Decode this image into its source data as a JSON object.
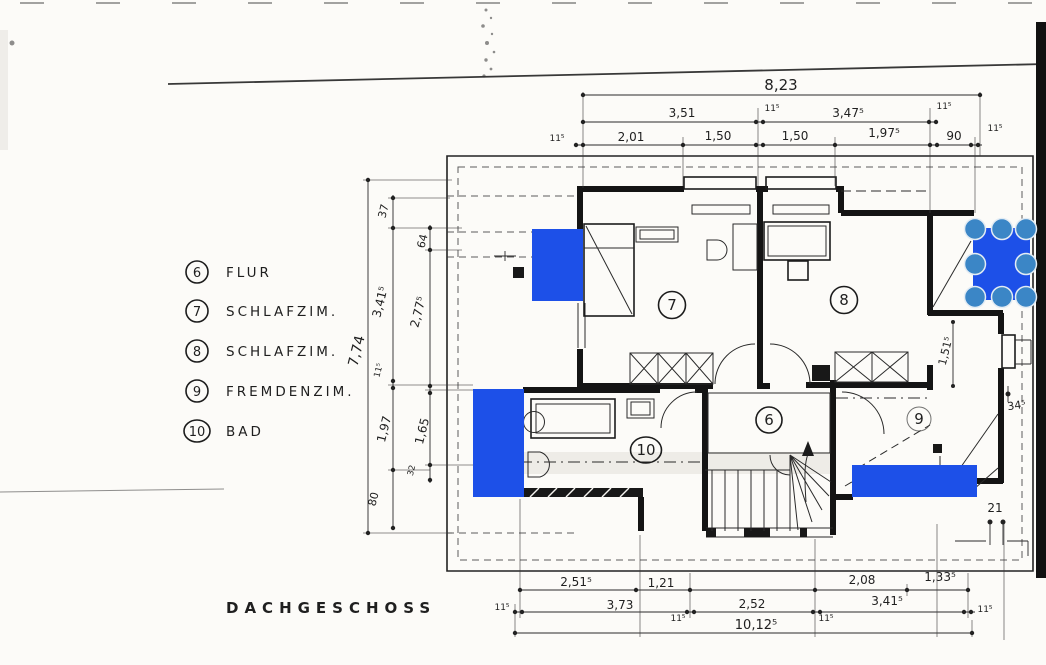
{
  "title": "DACHGESCHOSS",
  "legend": [
    {
      "num": "6",
      "label": "FLUR"
    },
    {
      "num": "7",
      "label": "SCHLAFZIM."
    },
    {
      "num": "8",
      "label": "SCHLAFZIM."
    },
    {
      "num": "9",
      "label": "FREMDENZIM."
    },
    {
      "num": "10",
      "label": "BAD"
    }
  ],
  "rooms": {
    "flur": "6",
    "schlafzim_west": "7",
    "schlafzim_east": "8",
    "fremdenzim": "9",
    "bad": "10"
  },
  "dims": {
    "top_total": "8,23",
    "top_row2": [
      "3,51",
      "11⁵",
      "3,47⁵",
      "11⁵"
    ],
    "top_row3": [
      "11⁵",
      "2,01",
      "1,50",
      "1,50",
      "1,97⁵",
      "90",
      "11⁵"
    ],
    "bottom_row1": [
      "2,51⁵",
      "1,21",
      "2,08",
      "1,33⁵"
    ],
    "bottom_row2": [
      "11⁵",
      "3,73",
      "11⁵",
      "2,52",
      "11⁵",
      "3,41⁵",
      "11⁵"
    ],
    "bottom_total": "10,12⁵",
    "left_total": "7,74",
    "left_chain_a": [
      "37",
      "3,41⁵",
      "11⁵",
      "1,97",
      "80"
    ],
    "left_chain_b": [
      "64",
      "2,77⁵",
      "1,65",
      "32"
    ],
    "right_wall": "1,51⁵",
    "right_offset": "34⁵",
    "right_bottom": "21"
  },
  "annotation": {
    "fill": "#1d50e8",
    "handle_fill": "#3b86c6",
    "handle_ring": "#e3ecf4"
  }
}
